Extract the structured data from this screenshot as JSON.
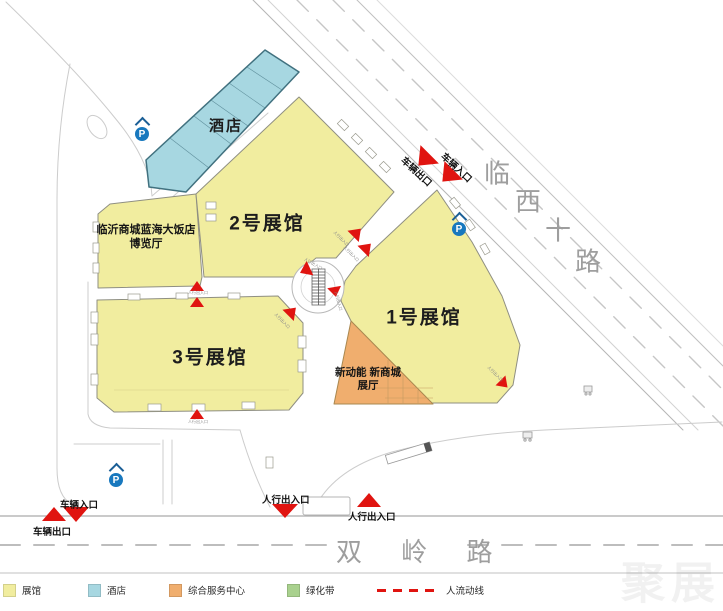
{
  "roads": {
    "northeast_chars": [
      "临",
      "西",
      "十",
      "路"
    ],
    "south": "双 岭 路"
  },
  "buildings": {
    "hotel_label": "酒店",
    "hall1_label": "1号展馆",
    "hall2_label": "2号展馆",
    "hall3_label": "3号展馆",
    "expo_hall_line1": "临沂商城蓝海大饭店",
    "expo_hall_line2": "博览厅",
    "service_line1": "新动能 新商城",
    "service_line2": "展厅"
  },
  "markers": {
    "vehicle_entrance": "车辆入口",
    "vehicle_exit": "车辆出口",
    "pedestrian_gate": "人行出入口",
    "parking_letter": "P",
    "tiny_flow_label": "人行出入口"
  },
  "legend": {
    "items": [
      {
        "label": "展馆",
        "color": "#f1ed9f"
      },
      {
        "label": "酒店",
        "color": "#a7d7e1"
      },
      {
        "label": "综合服务中心",
        "color": "#f0ae6e"
      },
      {
        "label": "绿化带",
        "color": "#a9d18e"
      }
    ],
    "flow_label": "人流动线"
  },
  "watermark": "聚展",
  "colors": {
    "hall": "#f1ed9f",
    "hotel": "#a7d7e1",
    "service": "#f0ae6e",
    "green": "#a9d18e",
    "flow_red": "#e01410",
    "road_text": "#9e9e9e",
    "parking_blue": "#1878be",
    "hall_border": "#8f8f82",
    "hotel_border": "#41717f"
  }
}
